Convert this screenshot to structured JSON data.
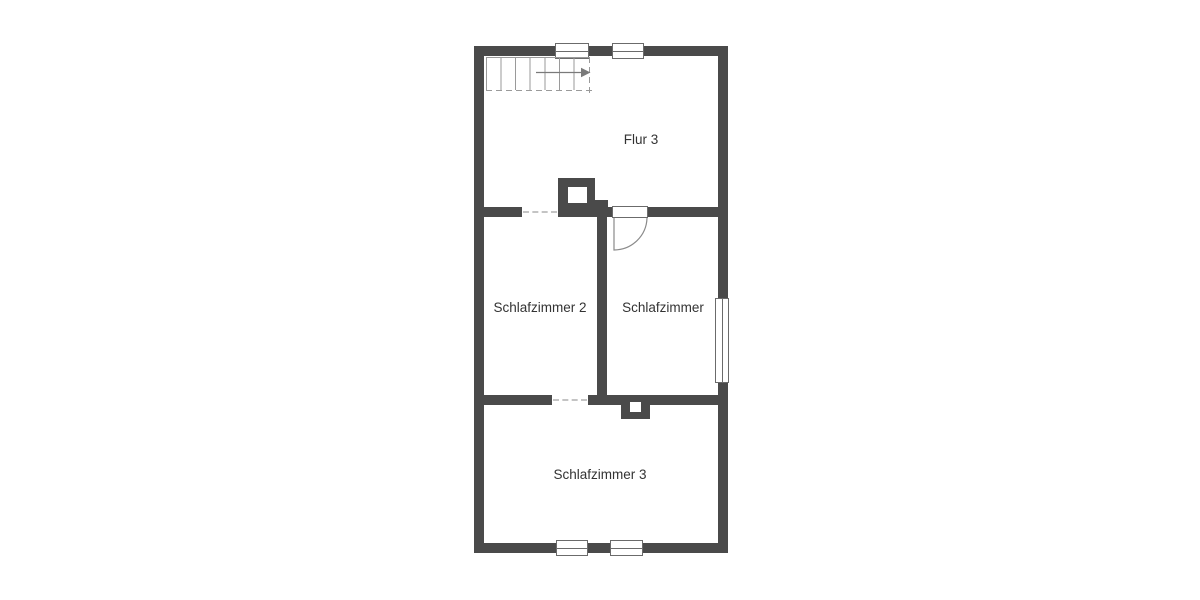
{
  "floorplan": {
    "rooms": [
      {
        "name": "flur-3",
        "label": "Flur 3"
      },
      {
        "name": "schlafzimmer-2",
        "label": "Schlafzimmer 2"
      },
      {
        "name": "schlafzimmer",
        "label": "Schlafzimmer"
      },
      {
        "name": "schlafzimmer-3",
        "label": "Schlafzimmer 3"
      }
    ],
    "symbols": {
      "windows": 5,
      "doors": 1,
      "stairs": 1,
      "chimneys": 2,
      "wall_openings": 2
    },
    "colors": {
      "wall": "#4a4a4a",
      "background": "#ffffff",
      "text": "#333333",
      "symbol_line": "#9a9a9a"
    }
  }
}
